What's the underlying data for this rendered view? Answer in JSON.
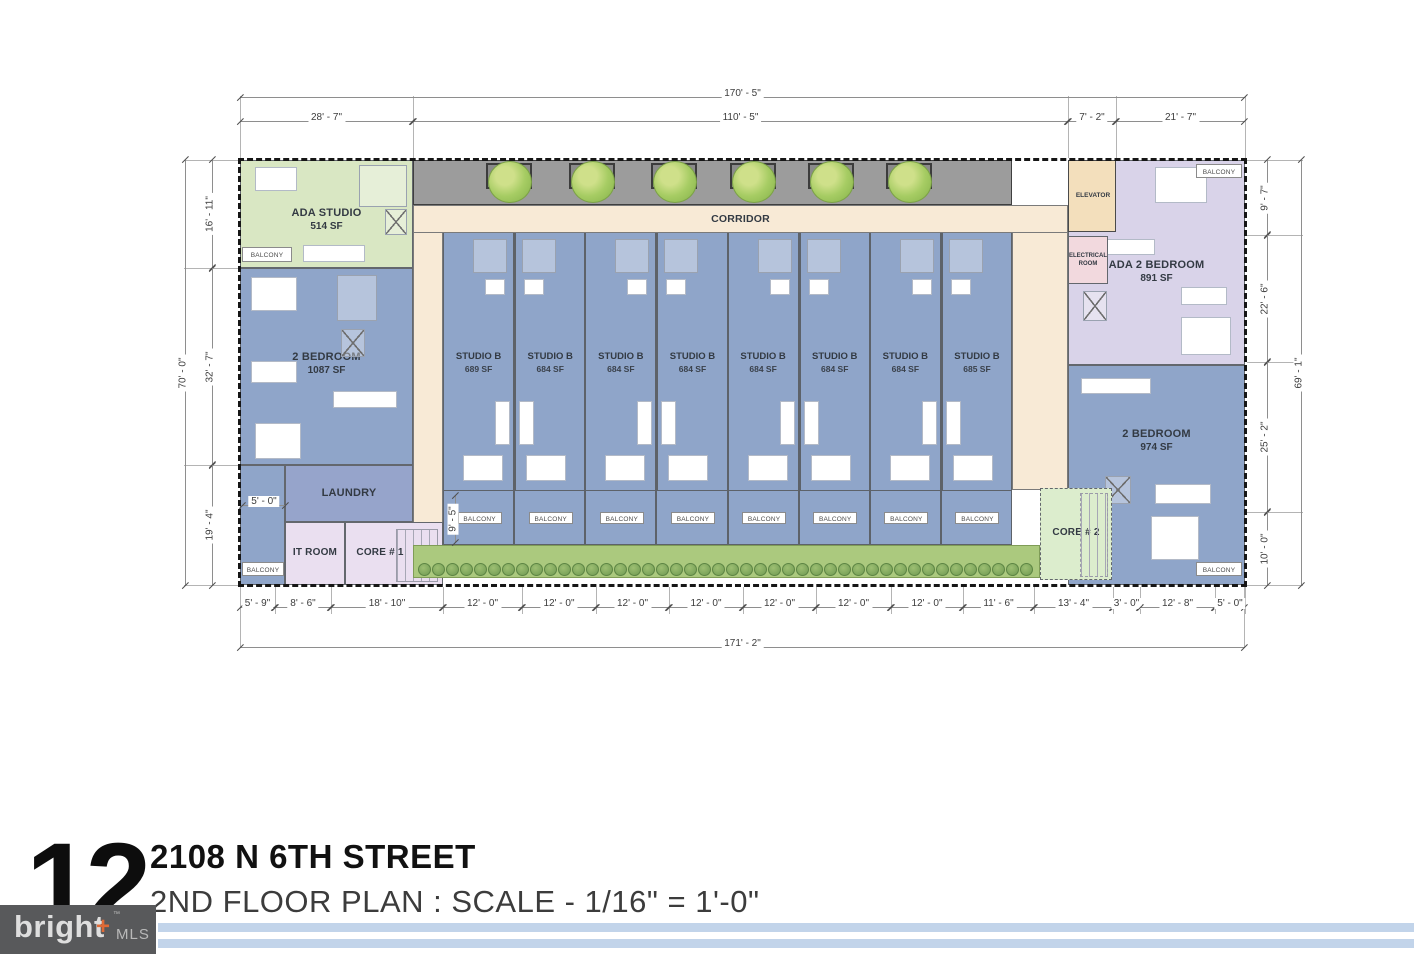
{
  "title_block": {
    "page_number": "12",
    "address": "2108 N 6TH STREET",
    "subtitle": "2ND FLOOR PLAN : SCALE - 1/16\" = 1'-0\"",
    "logo": {
      "brand": "bright",
      "plus": "+",
      "tm": "™",
      "suffix": "MLS"
    }
  },
  "plan": {
    "corridor_label": "CORRIDOR",
    "balcony_label": "BALCONY",
    "rooms": {
      "ada_studio": {
        "name": "ADA STUDIO",
        "sf": "514 SF"
      },
      "two_bedroom_left": {
        "name": "2 BEDROOM",
        "sf": "1087 SF"
      },
      "laundry": {
        "name": "LAUNDRY"
      },
      "it_room": {
        "name": "IT ROOM"
      },
      "core1": {
        "name": "CORE # 1"
      },
      "core2": {
        "name": "CORE # 2"
      },
      "elevator": {
        "name": "ELEVATOR"
      },
      "electrical": {
        "name": "ELECTRICAL ROOM"
      },
      "ada_two_bedroom": {
        "name": "ADA 2 BEDROOM",
        "sf": "891 SF"
      },
      "two_bedroom_right": {
        "name": "2 BEDROOM",
        "sf": "974 SF"
      }
    },
    "studios": [
      {
        "name": "STUDIO B",
        "sf": "689 SF"
      },
      {
        "name": "STUDIO B",
        "sf": "684 SF"
      },
      {
        "name": "STUDIO B",
        "sf": "684 SF"
      },
      {
        "name": "STUDIO B",
        "sf": "684 SF"
      },
      {
        "name": "STUDIO B",
        "sf": "684 SF"
      },
      {
        "name": "STUDIO B",
        "sf": "684 SF"
      },
      {
        "name": "STUDIO B",
        "sf": "684 SF"
      },
      {
        "name": "STUDIO B",
        "sf": "685 SF"
      }
    ]
  },
  "dimensions": {
    "top_overall": "170' - 5\"",
    "top_segments": [
      "28' - 7\"",
      "110' - 5\"",
      "7' - 2\"",
      "21' - 7\""
    ],
    "bottom_segments": [
      "5' - 9\"",
      "8' - 6\"",
      "18' - 10\"",
      "12' - 0\"",
      "12' - 0\"",
      "12' - 0\"",
      "12' - 0\"",
      "12' - 0\"",
      "12' - 0\"",
      "12' - 0\"",
      "11' - 6\"",
      "13' - 4\"",
      "3' - 0\"",
      "12' - 8\"",
      "5' - 0\""
    ],
    "bottom_overall": "171' - 2\"",
    "left_overall": "70' - 0\"",
    "left_segments": [
      "16' - 11\"",
      "32' - 7\"",
      "19' - 4\""
    ],
    "right_overall": "69' - 1\"",
    "right_segments": [
      "9' - 7\"",
      "22' - 6\"",
      "25' - 2\"",
      "10' - 0\""
    ],
    "interior": {
      "balcony_depth": "9' - 5\"",
      "left_balcony": "5' - 0\""
    }
  },
  "colors": {
    "unit_blue": "#8fa5c9",
    "laundry_blue": "#96a4cb",
    "unit_green": "#d9e7c3",
    "core_green": "#dcedcd",
    "unit_lavender": "#d9d3e9",
    "core_lavender": "#eadff0",
    "corridor_cream": "#f8ead6",
    "walkway_gray": "#9c9c9c",
    "elevator_peach": "#f3dfbc",
    "electrical_pink": "#f2d9de",
    "landscape_green": "#abc97e"
  }
}
